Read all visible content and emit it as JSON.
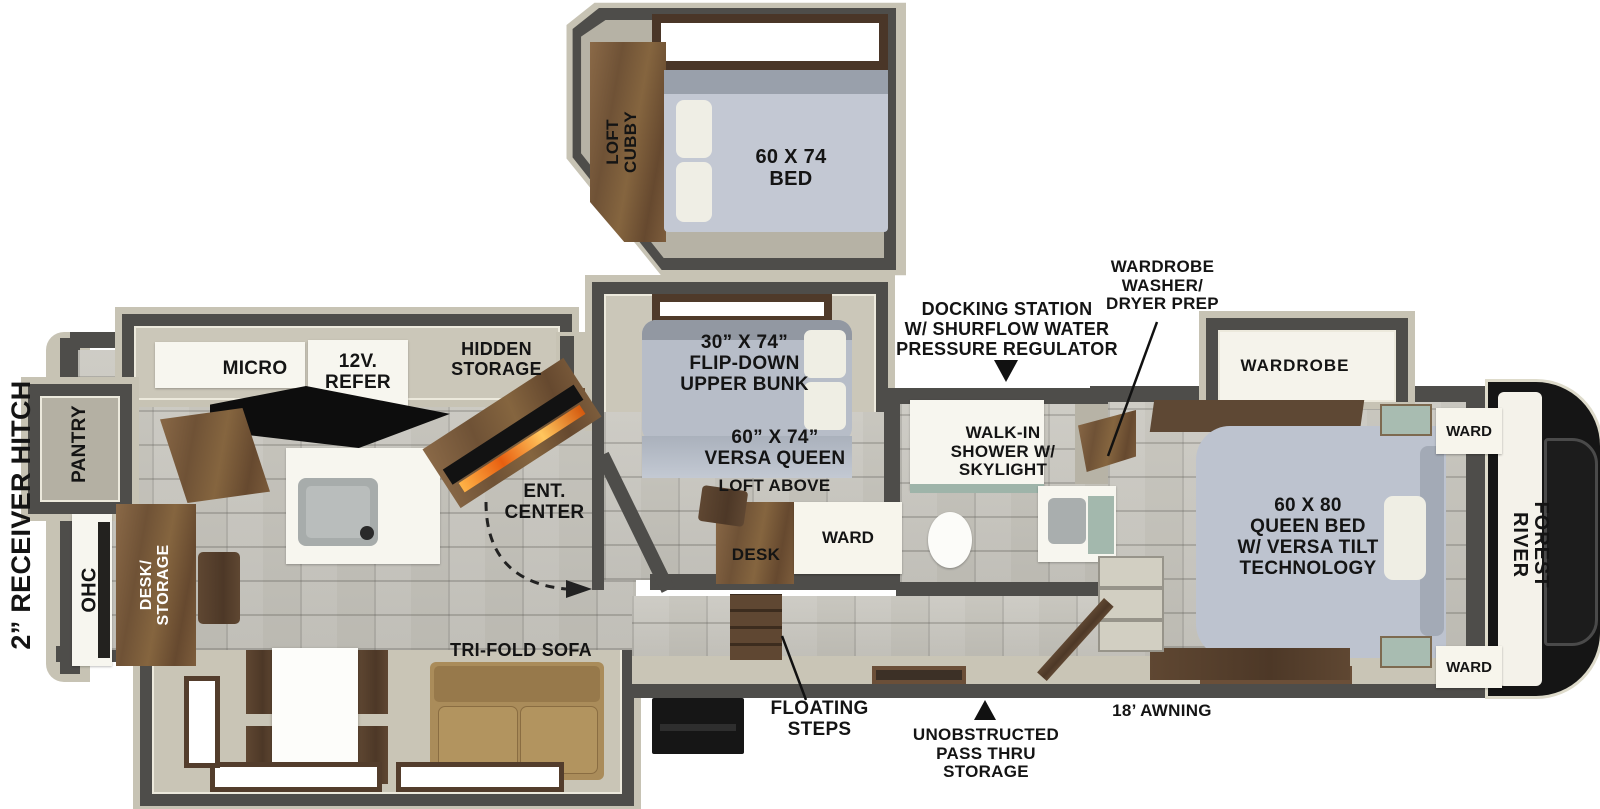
{
  "brand": "FOREST RIVER",
  "rear": {
    "receiver_hitch": "2” RECEIVER HITCH",
    "pantry": "PANTRY",
    "ohc": "OHC",
    "desk_storage": "DESK/\nSTORAGE"
  },
  "kitchen": {
    "micro": "MICRO",
    "refer": "12V.\nREFER",
    "hidden_storage": "HIDDEN\nSTORAGE",
    "ent_center": "ENT.\nCENTER"
  },
  "living": {
    "sofa": "TRI-FOLD SOFA"
  },
  "loft": {
    "cubby": "LOFT\nCUBBY",
    "bed": "60 X 74\nBED"
  },
  "bunk_room": {
    "upper_bunk": "30” X 74”\nFLIP-DOWN\nUPPER BUNK",
    "versa_queen": "60” X 74”\nVERSA QUEEN",
    "loft_above": "LOFT ABOVE",
    "desk": "DESK",
    "ward": "WARD"
  },
  "bathroom": {
    "shower": "WALK-IN\nSHOWER W/\nSKYLIGHT"
  },
  "bedroom": {
    "wardrobe": "WARDROBE",
    "queen_bed": "60 X 80\nQUEEN BED\nW/ VERSA TILT\nTECHNOLOGY",
    "ward_top": "WARD",
    "ward_bottom": "WARD"
  },
  "callouts": {
    "docking_station": "DOCKING STATION\nW/ SHURFLOW WATER\nPRESSURE REGULATOR",
    "washer_dryer_prep": "WARDROBE\nWASHER/\nDRYER PREP",
    "floating_steps": "FLOATING\nSTEPS",
    "pass_thru": "UNOBSTRUCTED\nPASS THRU\nSTORAGE",
    "awning": "18’ AWNING"
  },
  "colors": {
    "wall": "#4e4d4a",
    "shell": "#c7c3b4",
    "floor": "#c5c3bb",
    "mattress": "#bdc3cf",
    "wood": "#7d5f42",
    "sofa": "#aa8c5a",
    "teal": "#a3b8ad",
    "fire": "#e8832a",
    "label": "#141414"
  }
}
